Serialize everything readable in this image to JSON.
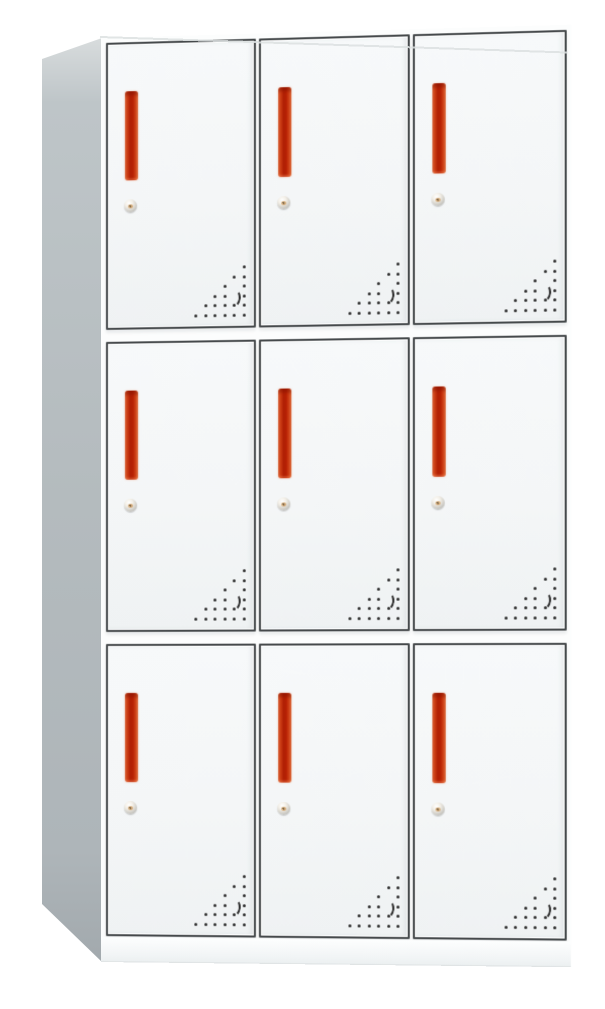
{
  "scene": {
    "type": "product-photo",
    "subject": "9-door metal locker cabinet",
    "description": "Front-left view of a white steel locker cabinet with a 3x3 grid of compartment doors; each door has a vertical red-orange recessed handle, a round silver cam lock below it, and a triangular pattern of ventilation holes with a small crescent cutout in the lower-right corner. Gray left side panel visible in perspective, white plinth base at the bottom.",
    "background": "#ffffff"
  },
  "cabinet": {
    "grid": {
      "rows": 3,
      "columns": 3,
      "door_count": 9
    },
    "door_components": {
      "handle": {
        "name": "vertical-bar-handle",
        "style": "recessed"
      },
      "lock": {
        "name": "round-cam-lock"
      },
      "vents": {
        "pattern": "right-aligned-triangle-dots",
        "rows": 6,
        "step_px": 9.5,
        "skip": [
          [
            2,
            1
          ],
          [
            3,
            1
          ]
        ],
        "decoration": "crescent-mark"
      }
    }
  },
  "colors": {
    "background": "#ffffff",
    "side_panel_top": "#d8dcdd",
    "side_panel": "#b4bbbe",
    "side_panel_bottom": "#a2a9ad",
    "front_face": "#fcfdfd",
    "door_fill": "#f4f6f7",
    "door_border": "#45494b",
    "handle_core": "#b01f04",
    "handle_edge": "#ef8049",
    "lock_silver": "#d9d6cf",
    "lock_gold": "#cfa068",
    "vent_dot": "#2d2d2d",
    "top_edge_line": "#dce0e1",
    "base_bottom_line": "#dfe3e4"
  }
}
